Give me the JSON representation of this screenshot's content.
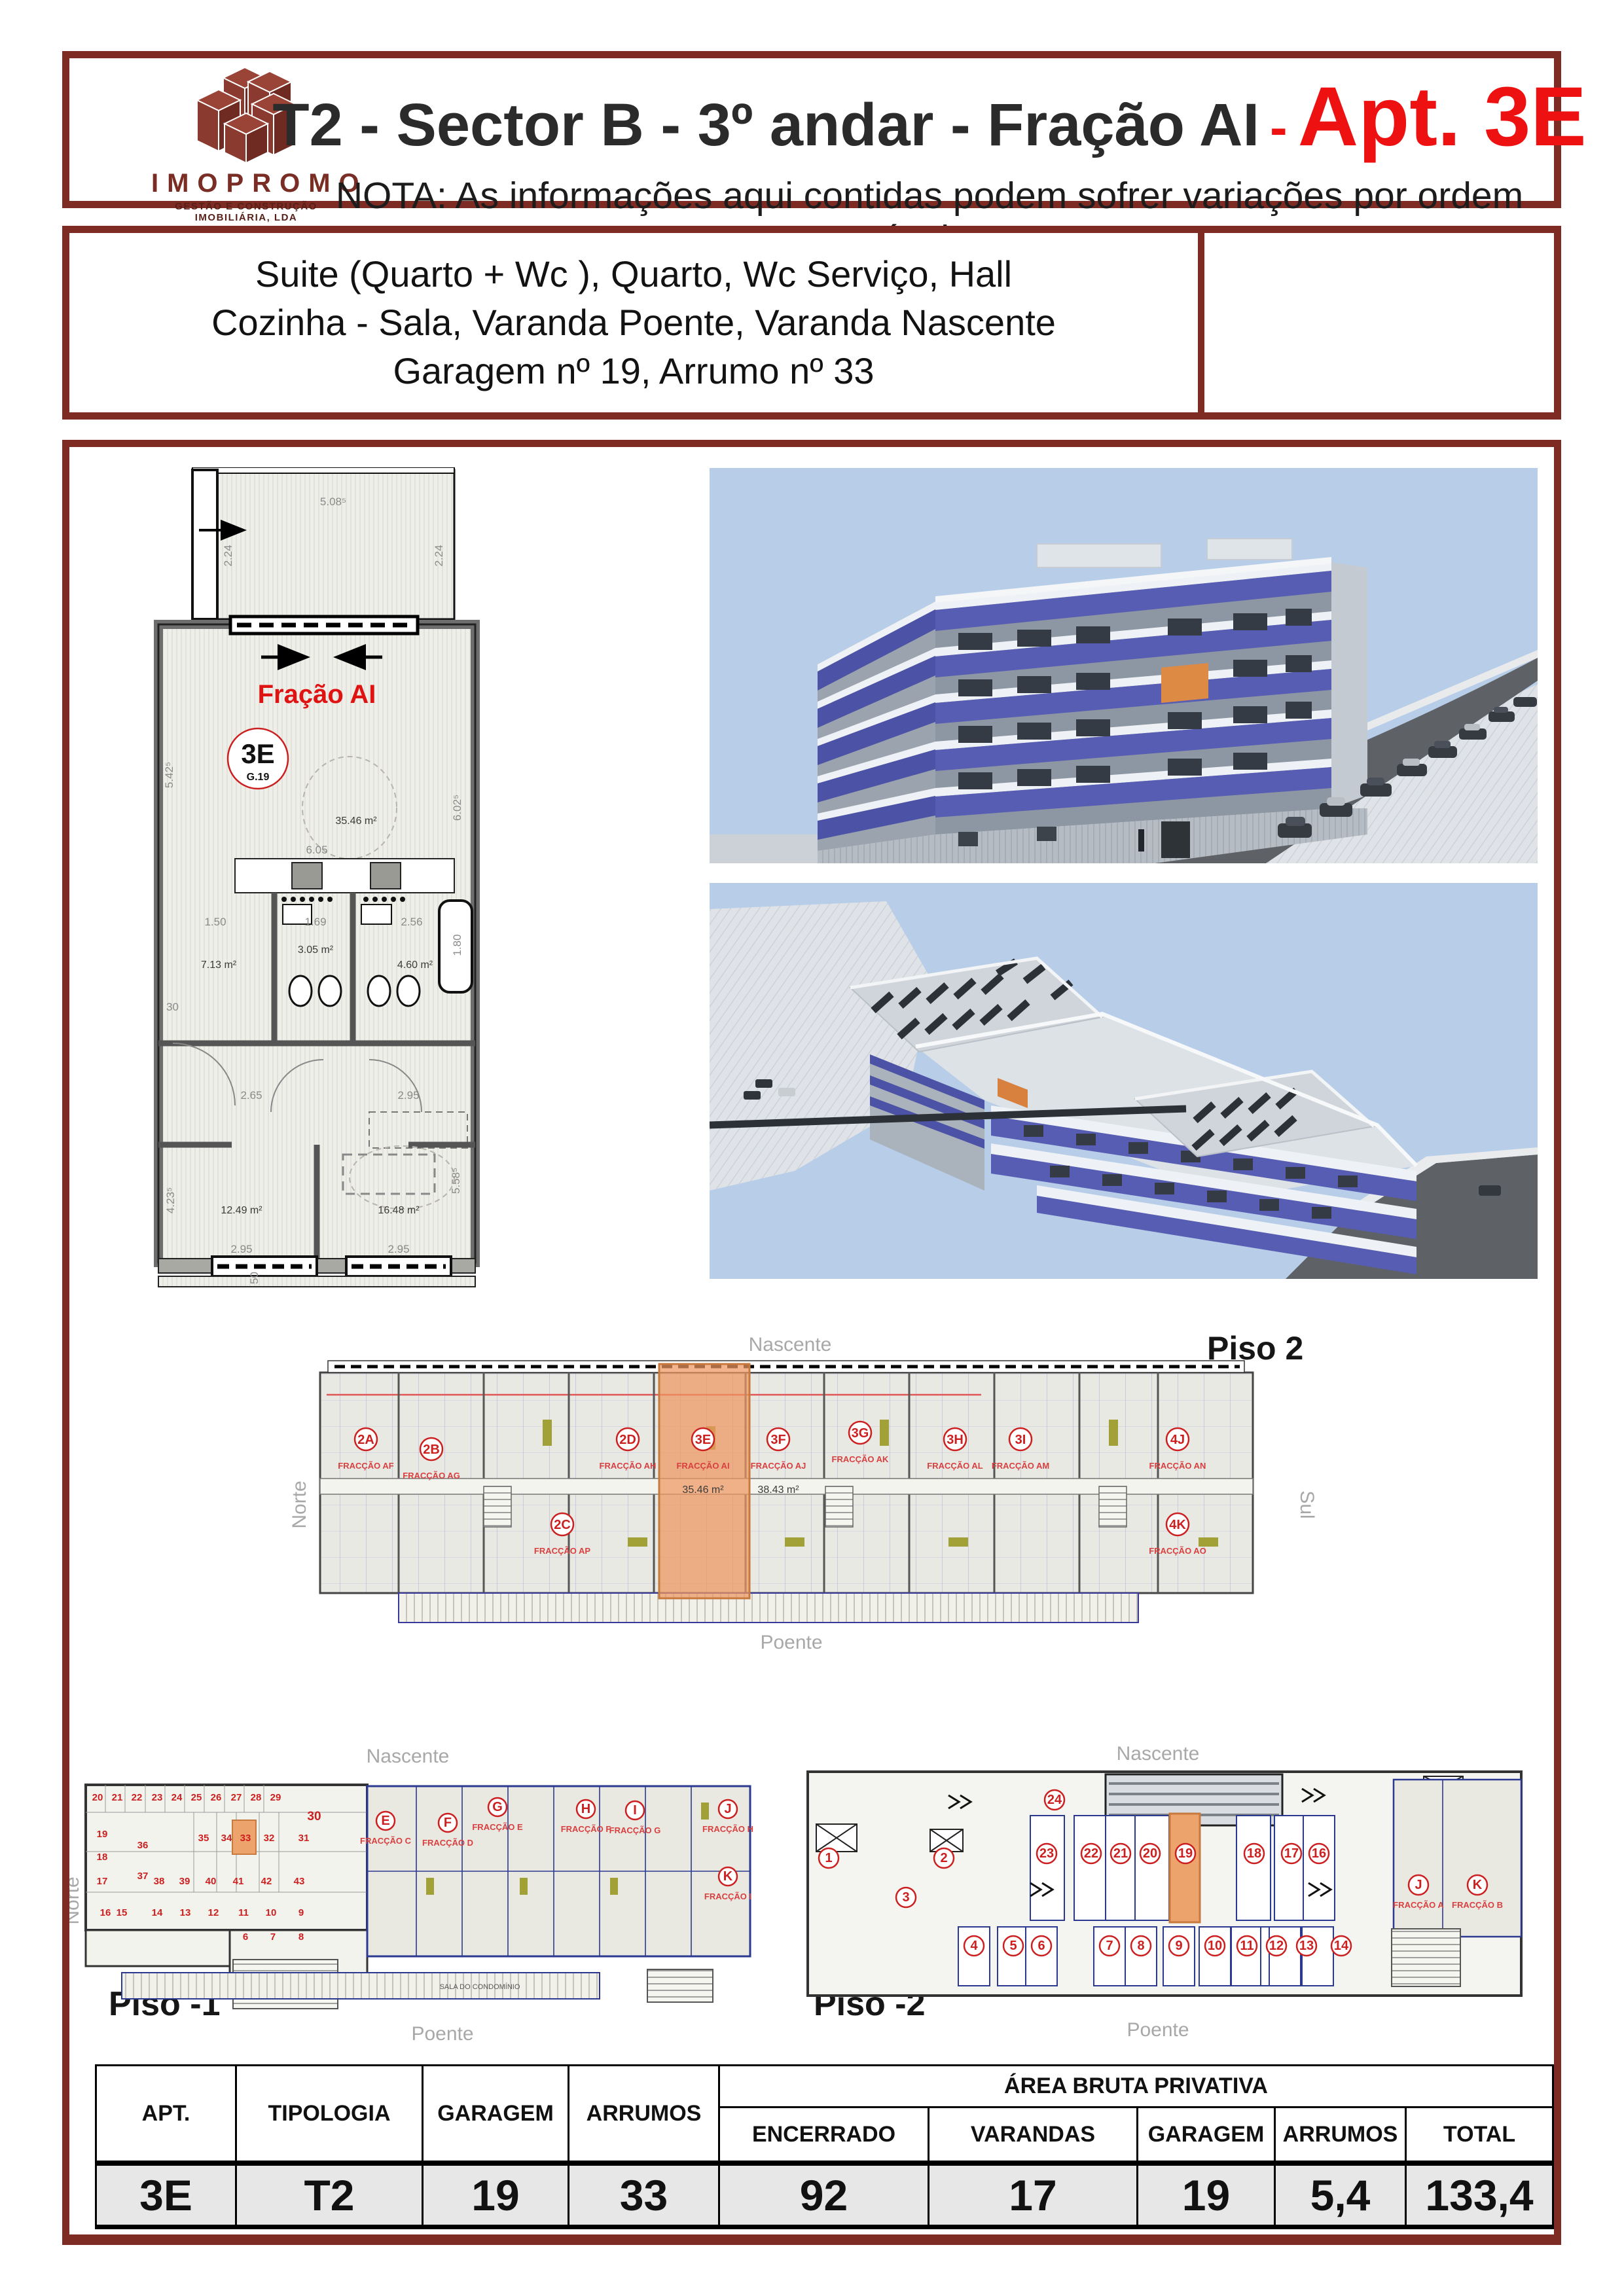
{
  "colors": {
    "frame": "#7d2b23",
    "accent_red": "#ee1111",
    "plan_red": "#e01313",
    "sky": "#b7cde8",
    "balcony_blue": "#575db3",
    "highlight_orange": "#eda36c",
    "table_row_bg": "#e7e7e7"
  },
  "header": {
    "logo_brand": "IMOPROMO",
    "logo_tagline": "GESTÃO E CONSTRUÇÃO IMOBILIÁRIA, LDA",
    "title_black": "T2 - Sector B - 3º andar - Fração AI",
    "title_sep": "-",
    "title_red": "Apt. 3E",
    "note": "NOTA: As informações aqui contidas podem sofrer variações por ordem técnica"
  },
  "description": {
    "line1": "Suite (Quarto + Wc ), Quarto, Wc Serviço, Hall",
    "line2": "Cozinha - Sala, Varanda Poente, Varanda Nascente",
    "line3": "Garagem nº 19, Arrumo nº 33"
  },
  "apartment_plan": {
    "fraction_label": "Fração AI",
    "unit_badge": "3E",
    "garage_badge": "G.19",
    "areas": {
      "living": "35.46 m²",
      "kitchen": "7.13 m²",
      "wc": "3.05 m²",
      "suite_wc": "4.60 m²",
      "bed1": "12.49 m²",
      "bed2": "16.48 m²"
    },
    "dims": {
      "w_top": "5.08⁵",
      "d_left": "2.24",
      "d_right": "2.24",
      "living_w": "6.05",
      "k_left": "1.50",
      "k_mid": "1.69",
      "k_right": "2.56",
      "k_tub": "1.80",
      "hall": "2.65",
      "hall2": "2.95",
      "bed1_w": "2.95",
      "bed2_w": "2.95",
      "h_left": "5.42⁵",
      "h_right": "6.02⁵",
      "h_bed1": "4.23⁵",
      "h_bed2": "5.58⁵",
      "wall": "30",
      "wall2": "35",
      "rail": "50"
    }
  },
  "piso2": {
    "title": "Piso 2",
    "orient": {
      "n": "Nascente",
      "s": "Poente",
      "w": "Norte",
      "e": "Sul"
    },
    "units": [
      {
        "b": "2A",
        "f": "FRACÇÃO AF"
      },
      {
        "b": "2B",
        "f": "FRACÇÃO AG"
      },
      {
        "b": "2D",
        "f": "FRACÇÃO AH"
      },
      {
        "b": "3E",
        "f": "FRACÇÃO AI",
        "a": "35.46 m²"
      },
      {
        "b": "3F",
        "f": "FRACÇÃO AJ",
        "a": "38.43 m²"
      },
      {
        "b": "3G",
        "f": "FRACÇÃO AK"
      },
      {
        "b": "3H",
        "f": "FRACÇÃO AL"
      },
      {
        "b": "3I",
        "f": "FRACÇÃO AM"
      },
      {
        "b": "4J",
        "f": "FRACÇÃO AN"
      },
      {
        "b": "2C",
        "f": "FRACÇÃO AP"
      },
      {
        "b": "4K",
        "f": "FRACÇÃO AO"
      }
    ]
  },
  "piso_m1": {
    "title": "Piso -1",
    "orient": {
      "n": "Nascente",
      "s": "Poente",
      "w": "Norte"
    },
    "storages": [
      "20",
      "21",
      "22",
      "23",
      "24",
      "25",
      "26",
      "27",
      "28",
      "29",
      "30",
      "19",
      "18",
      "17",
      "36",
      "37",
      "35",
      "34",
      "33",
      "32",
      "31",
      "38",
      "39",
      "40",
      "41",
      "42",
      "43",
      "16",
      "15",
      "14",
      "13",
      "12",
      "11",
      "10",
      "9",
      "6",
      "7",
      "8",
      "5",
      "4",
      "3",
      "2",
      "1"
    ],
    "units": [
      {
        "b": "E",
        "f": "FRACÇÃO C"
      },
      {
        "b": "F",
        "f": "FRACÇÃO D"
      },
      {
        "b": "G",
        "f": "FRACÇÃO E"
      },
      {
        "b": "H",
        "f": "FRACÇÃO F"
      },
      {
        "b": "I",
        "f": "FRACÇÃO G"
      },
      {
        "b": "J",
        "f": "FRACÇÃO H"
      },
      {
        "b": "K",
        "f": "FRACÇÃO I"
      }
    ],
    "room_label": "SALA DO CONDOMÍNIO"
  },
  "piso_m2": {
    "title": "Piso -2",
    "orient": {
      "n": "Nascente",
      "s": "Poente"
    },
    "garages": [
      "24",
      "23",
      "22",
      "21",
      "20",
      "19",
      "18",
      "17",
      "16",
      "1",
      "2",
      "3",
      "4",
      "5",
      "6",
      "7",
      "8",
      "9",
      "10",
      "11",
      "12",
      "13",
      "14"
    ],
    "units": [
      {
        "b": "J",
        "f": "FRACÇÃO A"
      },
      {
        "b": "K",
        "f": "FRACÇÃO B"
      }
    ]
  },
  "table": {
    "headers": {
      "apt": "APT.",
      "tipologia": "TIPOLOGIA",
      "garagem": "GARAGEM",
      "arrumos": "ARRUMOS",
      "area_group": "ÁREA BRUTA PRIVATIVA",
      "encerrado": "ENCERRADO",
      "varandas": "VARANDAS",
      "garagem2": "GARAGEM",
      "arrumos2": "ARRUMOS",
      "total": "TOTAL"
    },
    "row": {
      "apt": "3E",
      "tipologia": "T2",
      "garagem": "19",
      "arrumos": "33",
      "encerrado": "92",
      "varandas": "17",
      "garagem2": "19",
      "arrumos2": "5,4",
      "total": "133,4"
    }
  }
}
